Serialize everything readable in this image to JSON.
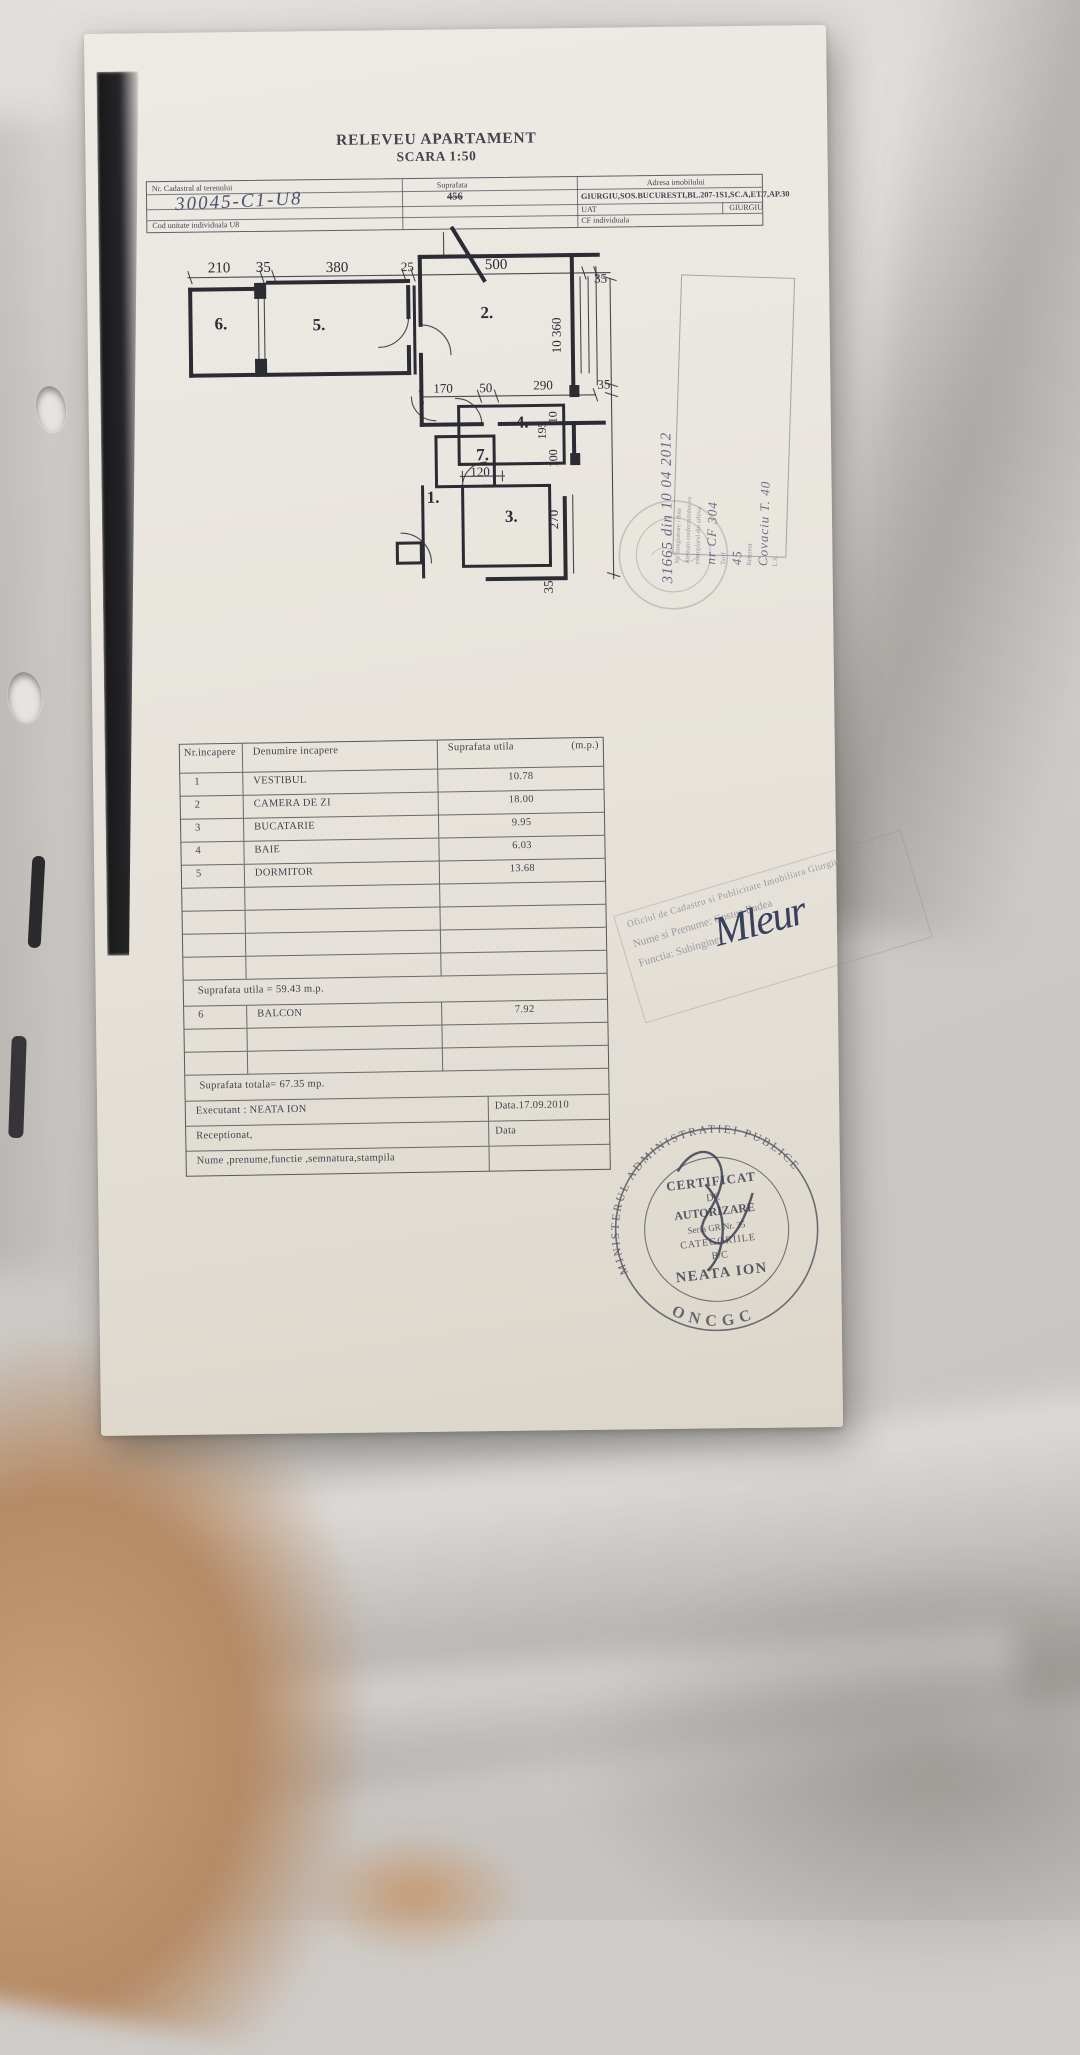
{
  "title": {
    "line1": "RELEVEU APARTAMENT",
    "line2": "SCARA 1:50"
  },
  "header_table": {
    "nr_cadastral_label": "Nr. Cadastral al terenului",
    "nr_cadastral_value": "30045-C1-U8",
    "suprafata_label": "Suprafata",
    "suprafata_value": "456",
    "adresa_label": "Adresa imobilului",
    "adresa_value": "GIURGIU,SOS.BUCURESTI,BL.207-1S1,SC.A,ET.7,AP.30",
    "uat_label": "UAT",
    "uat_value": "GIURGIU",
    "cod_unitate_label": "Cod unitate individuala U8",
    "cf_label": "CF individuala"
  },
  "floor_plan": {
    "dim_210": "210",
    "dim_35a": "35",
    "dim_380": "380",
    "dim_25": "25",
    "dim_500": "500",
    "dim_35b": "35",
    "dim_10_360": "10 360",
    "dim_35c": "35",
    "dim_170": "170",
    "dim_50": "50",
    "dim_290": "290",
    "dim_195": "195",
    "dim_10": "10",
    "dim_100": "100",
    "dim_120": "120",
    "dim_270": "270",
    "dim_35d": "35",
    "room_6": "6.",
    "room_5": "5.",
    "room_2": "2.",
    "room_4": "4.",
    "room_7": "7.",
    "room_1": "1.",
    "room_3": "3."
  },
  "room_table": {
    "header_nr": "Nr.incapere",
    "header_name": "Denumire incapere",
    "header_area": "Suprafata utila",
    "header_unit": "(m.p.)",
    "rows": [
      {
        "nr": "1",
        "name": "VESTIBUL",
        "area": "10.78"
      },
      {
        "nr": "2",
        "name": "CAMERA DE ZI",
        "area": "18.00"
      },
      {
        "nr": "3",
        "name": "BUCATARIE",
        "area": "9.95"
      },
      {
        "nr": "4",
        "name": "BAIE",
        "area": "6.03"
      },
      {
        "nr": "5",
        "name": "DORMITOR",
        "area": "13.68"
      }
    ],
    "subtotal": "Suprafata utila = 59.43   m.p.",
    "balcon": {
      "nr": "6",
      "name": "BALCON",
      "area": "7.92"
    },
    "total": "Suprafata totala= 67.35 mp.",
    "executant": "Executant : NEATA ION",
    "executant_data": "Data.17.09.2010",
    "receptionat": "Receptionat,",
    "receptionat_data": "Data",
    "footer": "Nume ,prenume,functie ,semnatura,stampila"
  },
  "annotations": {
    "reception_number": "31665 din 10 04 2012",
    "reception_box_lines": [
      "Nr. inregistrare / data",
      "Atestam conformitatea cu",
      "exemplarul din arhiva",
      "Tarif",
      "Referent",
      "L.S."
    ],
    "reception_hand_1": "nr CF 304",
    "reception_hand_2": "45",
    "reception_hand_3": "Covaciu T. 40",
    "signature": "Mleur"
  },
  "stamps": {
    "diagonal": {
      "line1": "Oficiul de Cadastru si Publicitate Imobiliara Giurgiu",
      "line2": "Nume si Prenume: Costea Badea",
      "line3": "Functia: Subinginer"
    },
    "round": {
      "arc_top": "MINISTERUL ADMINISTRATIEI PUBLICE",
      "arc_bottom": "ONCGC",
      "line1": "CERTIFICAT",
      "line2": "DE",
      "line3": "AUTORIZARE",
      "line4": "Seria GR Nr. 35",
      "line5": "CATEGORIILE",
      "line6": "B/C",
      "line7": "NEATA ION"
    }
  }
}
